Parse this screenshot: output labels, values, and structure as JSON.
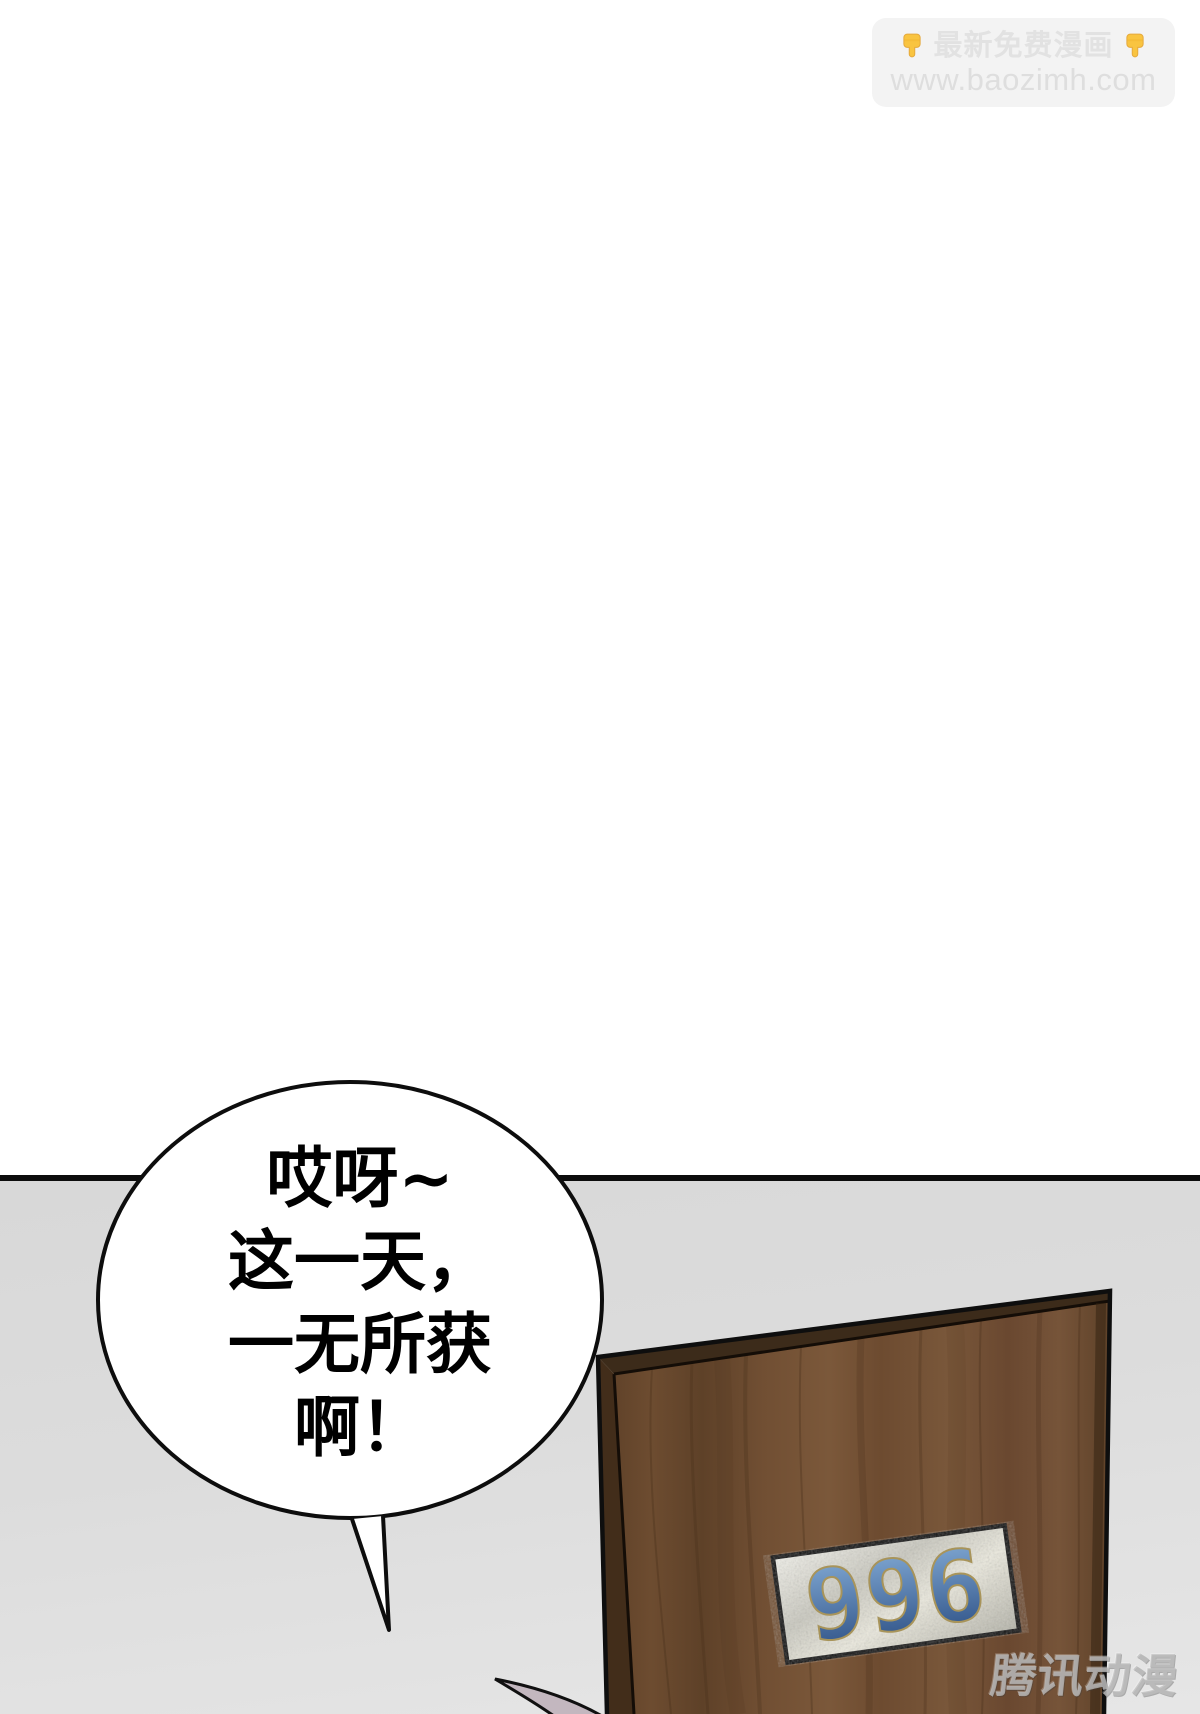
{
  "page": {
    "width": 1200,
    "height": 1714,
    "type": "comic-panel"
  },
  "watermark_top": {
    "left_icon": "point-down",
    "line1": "最新免费漫画",
    "right_icon": "point-down",
    "line2": "www.baozimh.com"
  },
  "bubble": {
    "lines": [
      "哎呀~",
      "这一天，",
      "一无所获",
      "啊！"
    ]
  },
  "door": {
    "plate_number": "996"
  },
  "watermark_bottom": {
    "text": "腾讯动漫"
  },
  "colors": {
    "wall": "#ffffff",
    "floor_top": "#d8d8d8",
    "floor_bottom": "#e6e6e6",
    "outline": "#0d0d0d",
    "wood": "#6e4c31",
    "wood_dark": "#3c2b1a",
    "plate_metal": "#d9d8cf",
    "plate_blue_top": "#86aed8",
    "plate_blue_bottom": "#2c4f84",
    "hair": "#c3b7bf",
    "watermark_bg": "#f3f3f3",
    "watermark_text": "#e2e2e2",
    "hand_yellow": "#f9c440",
    "tencent_gray": "#bebebe"
  }
}
